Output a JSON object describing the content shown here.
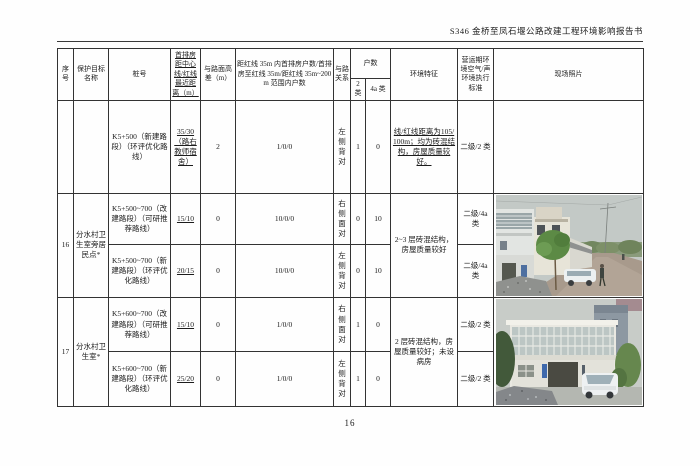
{
  "doc": {
    "title": "S346 金桥至凤石堰公路改建工程环境影响报告书",
    "page_number": "16"
  },
  "table": {
    "headers": {
      "index": "序号",
      "target_name": "保护目标名称",
      "stake": "桩号",
      "front_dist": "首排房距中心线/红线最近距离（m）",
      "height_diff": "与路面高差（m）",
      "house_counts": "距红线 35m 内首排房户数/首排房至红线 35m/距红线 35m~200m 范围内户数",
      "relation": "与路关系",
      "households": "户数",
      "class2": "2 类",
      "class4a": "4a 类",
      "env_feature": "环境特征",
      "standard": "营运期环境空气/声环境执行标准",
      "photo": "现场照片"
    },
    "r0": {
      "index": "",
      "name": "",
      "stake": "K5+500（新建路段）（环评优化路线）",
      "front_dist": "35/30（路右教师宿舍）",
      "height_diff": "2",
      "house_counts": "1/0/0",
      "relation": "左侧背对",
      "class2": "1",
      "class4a": "0",
      "env": "线/红线距离为105/100m；均为砖混结构，房屋质量较好。",
      "standard": "二级/2 类"
    },
    "r16": {
      "index": "16",
      "name": "分水村卫生室旁居民点*",
      "env": "2~3 层砖混结构，房屋质量较好",
      "sub": [
        {
          "stake": "K5+500~700（改建路段）（可研推荐路线）",
          "front_dist": "15/10",
          "height_diff": "0",
          "house_counts": "10/0/0",
          "relation": "右侧面对",
          "class2": "0",
          "class4a": "10",
          "standard": "二级/4a 类"
        },
        {
          "stake": "K5+500~700（新建路段）（环评优化路线）",
          "front_dist": "20/15",
          "height_diff": "0",
          "house_counts": "10/0/0",
          "relation": "左侧背对",
          "class2": "0",
          "class4a": "10",
          "standard": "二级/4a 类"
        }
      ]
    },
    "r17": {
      "index": "17",
      "name": "分水村卫生室*",
      "env": "2 层砖混结构，房屋质量较好；未设病房",
      "sub": [
        {
          "stake": "K5+600~700（改建路段）（可研推荐路线）",
          "front_dist": "15/10",
          "height_diff": "0",
          "house_counts": "1/0/0",
          "relation": "右侧面对",
          "class2": "1",
          "class4a": "0",
          "standard": "二级/2 类"
        },
        {
          "stake": "K5+600~700（新建路段）（环评优化路线）",
          "front_dist": "25/20",
          "height_diff": "0",
          "house_counts": "1/0/0",
          "relation": "左侧背对",
          "class2": "1",
          "class4a": "0",
          "standard": "二级/2 类"
        }
      ]
    }
  }
}
